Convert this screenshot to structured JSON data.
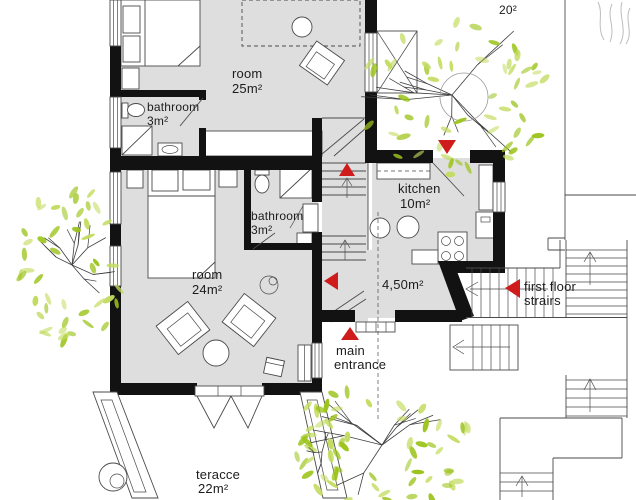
{
  "title": "ground floor plan",
  "colors": {
    "floor": "#dedede",
    "wall": "#121212",
    "line": "#4a4a4a",
    "red": "#cf1b1b",
    "leaf": "#9cc41c",
    "leaf2": "#c3dc60",
    "branch": "#3c3c3c",
    "faint": "#bdbdbd"
  },
  "labels": {
    "room25": {
      "name": "room",
      "area": "25m²"
    },
    "bathroom_top": {
      "name": "bathroom",
      "area": "3m²"
    },
    "bathroom_mid": {
      "name": "bathroom",
      "area": "3m²"
    },
    "kitchen": {
      "name": "kitchen",
      "area": "10m²"
    },
    "hall": {
      "area": "4,50m²"
    },
    "room24": {
      "name": "room",
      "area": "24m²"
    },
    "terrace": {
      "name": "teracce",
      "area": "22m²"
    },
    "upper_terrace": {
      "area": "20²"
    },
    "main_entrance": {
      "line1": "main",
      "line2": "entrance"
    },
    "first_floor_stairs": {
      "line1": "first floor",
      "line2": "strairs"
    }
  },
  "icons": [
    "stairs-up-arrow-icon",
    "stairs-down-left-arrow-icon",
    "kitchen-entrance-arrow-icon",
    "main-entrance-arrow-icon",
    "first-floor-stairs-arrow-icon"
  ],
  "trees": [
    {
      "name": "tree-top-right",
      "cx": 452,
      "cy": 95,
      "r": 100,
      "sx": 1,
      "sy": 0.8,
      "branches": 8,
      "leaves": 56,
      "seed": 11,
      "circle": true
    },
    {
      "name": "tree-left",
      "cx": 72,
      "cy": 265,
      "r": 88,
      "sx": 0.62,
      "sy": 0.9,
      "branches": 7,
      "leaves": 46,
      "seed": 22,
      "circle": false
    },
    {
      "name": "tree-bottom",
      "cx": 382,
      "cy": 445,
      "r": 92,
      "sx": 1,
      "sy": 0.75,
      "branches": 7,
      "leaves": 48,
      "seed": 33,
      "circle": false
    },
    {
      "name": "vine-right-post",
      "cx": 322,
      "cy": 452,
      "r": 45,
      "sx": 0.45,
      "sy": 1,
      "branches": 3,
      "leaves": 16,
      "seed": 44,
      "circle": false
    }
  ]
}
